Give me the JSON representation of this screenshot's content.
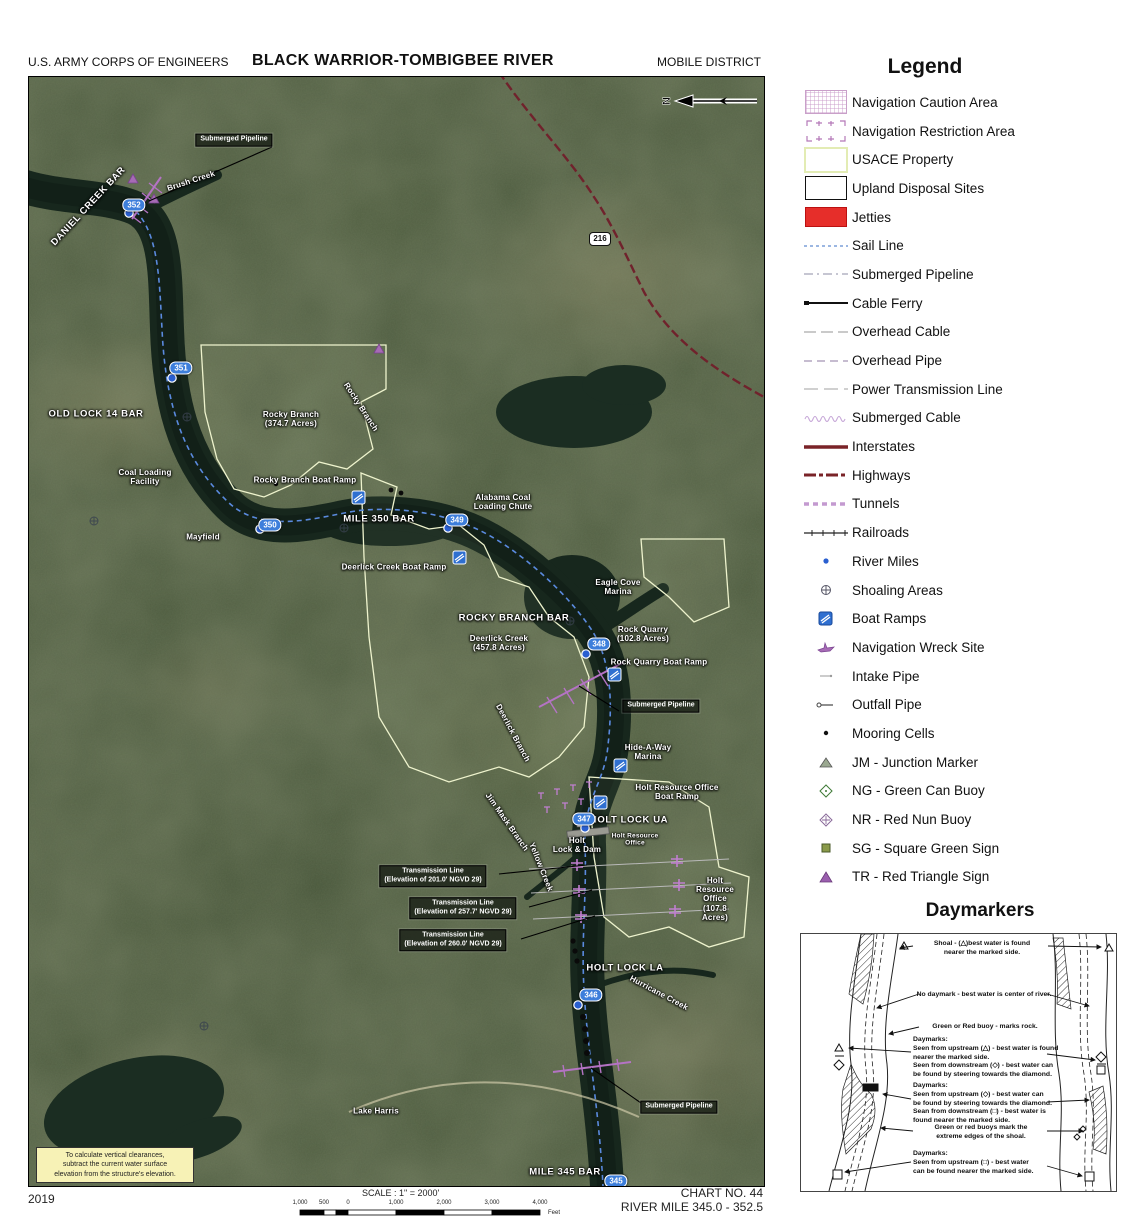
{
  "header": {
    "agency": "U.S. ARMY CORPS OF ENGINEERS",
    "title": "BLACK WARRIOR-TOMBIGBEE RIVER",
    "district": "MOBILE DISTRICT"
  },
  "footer": {
    "year": "2019",
    "scale_label": "SCALE : 1\" = 2000'",
    "scale_ticks": [
      "1,000",
      "500",
      "0",
      "1,000",
      "2,000",
      "3,000",
      "4,000"
    ],
    "scale_unit": "Feet",
    "chart_no": "CHART NO. 44",
    "river_mile_range": "RIVER MILE 345.0 - 352.5"
  },
  "legend": {
    "title": "Legend",
    "items": [
      {
        "label": "Navigation Caution Area",
        "icon": "caution-area-swatch"
      },
      {
        "label": "Navigation Restriction Area",
        "icon": "restriction-area-swatch"
      },
      {
        "label": "USACE Property",
        "icon": "usace-property-swatch"
      },
      {
        "label": "Upland Disposal Sites",
        "icon": "upland-disposal-swatch"
      },
      {
        "label": "Jetties",
        "icon": "jetties-swatch"
      },
      {
        "label": "Sail Line",
        "icon": "sail-line-swatch"
      },
      {
        "label": "Submerged Pipeline",
        "icon": "submerged-pipeline-swatch"
      },
      {
        "label": "Cable Ferry",
        "icon": "cable-ferry-swatch"
      },
      {
        "label": "Overhead Cable",
        "icon": "overhead-cable-swatch"
      },
      {
        "label": "Overhead Pipe",
        "icon": "overhead-pipe-swatch"
      },
      {
        "label": "Power Transmission Line",
        "icon": "power-transmission-line-swatch"
      },
      {
        "label": "Submerged Cable",
        "icon": "submerged-cable-swatch"
      },
      {
        "label": "Interstates",
        "icon": "interstates-swatch"
      },
      {
        "label": "Highways",
        "icon": "highways-swatch"
      },
      {
        "label": "Tunnels",
        "icon": "tunnels-swatch"
      },
      {
        "label": "Railroads",
        "icon": "railroads-swatch"
      },
      {
        "label": "River Miles",
        "icon": "river-miles-swatch"
      },
      {
        "label": "Shoaling Areas",
        "icon": "shoaling-areas-swatch"
      },
      {
        "label": "Boat Ramps",
        "icon": "boat-ramps-swatch"
      },
      {
        "label": "Navigation Wreck Site",
        "icon": "wreck-site-swatch"
      },
      {
        "label": "Intake Pipe",
        "icon": "intake-pipe-swatch"
      },
      {
        "label": "Outfall Pipe",
        "icon": "outfall-pipe-swatch"
      },
      {
        "label": "Mooring Cells",
        "icon": "mooring-cells-swatch"
      },
      {
        "label": "JM - Junction Marker",
        "icon": "junction-marker-swatch"
      },
      {
        "label": "NG - Green Can Buoy",
        "icon": "green-can-buoy-swatch"
      },
      {
        "label": "NR - Red Nun Buoy",
        "icon": "red-nun-buoy-swatch"
      },
      {
        "label": "SG - Square Green Sign",
        "icon": "square-green-sign-swatch"
      },
      {
        "label": "TR - Red Triangle Sign",
        "icon": "red-triangle-sign-swatch"
      }
    ]
  },
  "daymarkers": {
    "title": "Daymarkers",
    "notes": [
      {
        "text": "Shoal - (△)best water is found\nnearer the marked side."
      },
      {
        "text": "No daymark - best water is center of river."
      },
      {
        "text": "Green or Red buoy - marks rock."
      },
      {
        "text": "Daymarks:\nSeen from upstream (△) - best water is found\nnearer the marked side.\nSeen from downstream (◇) - best water can\nbe found by steering towards the diamond."
      },
      {
        "text": "Daymarks:\nSeen from upstream (◇) - best water can\nbe found by steering towards the diamond.\nSean from downstream (□) - best water is\nfound nearer the marked side."
      },
      {
        "text": "Green or red buoys mark the\nextreme edges of the shoal."
      },
      {
        "text": "Daymarks:\nSeen from upstream (□) - best water\ncan be found nearer the marked side."
      }
    ]
  },
  "map": {
    "compass_label": "N",
    "route_shield": "216",
    "note_box": "To calculate vertical clearances,\nsubtract the current water surface\nelevation from the structure's elevation.",
    "mile_markers": [
      "352",
      "351",
      "350",
      "349",
      "348",
      "347",
      "346",
      "345"
    ],
    "labels": [
      {
        "text": "Submerged Pipeline"
      },
      {
        "text": "DANIEL CREEK BAR"
      },
      {
        "text": "Brush Creek"
      },
      {
        "text": "OLD LOCK 14 BAR"
      },
      {
        "text": "Rocky Branch\n(374.7 Acres)"
      },
      {
        "text": "Rocky Branch"
      },
      {
        "text": "Coal Loading\nFacility"
      },
      {
        "text": "Rocky Branch Boat Ramp"
      },
      {
        "text": "MILE 350 BAR"
      },
      {
        "text": "Mayfield"
      },
      {
        "text": "Alabama Coal\nLoading Chute"
      },
      {
        "text": "Deerlick Creek Boat Ramp"
      },
      {
        "text": "Eagle Cove\nMarina"
      },
      {
        "text": "ROCKY BRANCH BAR"
      },
      {
        "text": "Deerlick Creek\n(457.8 Acres)"
      },
      {
        "text": "Rock Quarry\n(102.8 Acres)"
      },
      {
        "text": "Rock Quarry Boat Ramp"
      },
      {
        "text": "Submerged Pipeline"
      },
      {
        "text": "Deerlick Branch"
      },
      {
        "text": "Hide-A-Way\nMarina"
      },
      {
        "text": "Holt Resource Office Boat Ramp"
      },
      {
        "text": "Jim Mask Branch"
      },
      {
        "text": "HOLT LOCK UA"
      },
      {
        "text": "Holt\nLock & Dam"
      },
      {
        "text": "Holt Resource\nOffice"
      },
      {
        "text": "Yellow Creek"
      },
      {
        "text": "Transmission Line\n(Elevation of 201.0' NGVD 29)"
      },
      {
        "text": "Transmission Line\n(Elevation of 257.7' NGVD 29)"
      },
      {
        "text": "Transmission Line\n(Elevation of 260.0' NGVD 29)"
      },
      {
        "text": "Holt Resource Office\n(107.8 Acres)"
      },
      {
        "text": "HOLT LOCK LA"
      },
      {
        "text": "Hurricane Creek"
      },
      {
        "text": "Submerged Pipeline"
      },
      {
        "text": "Lake Harris"
      },
      {
        "text": "MILE 345 BAR"
      }
    ]
  }
}
